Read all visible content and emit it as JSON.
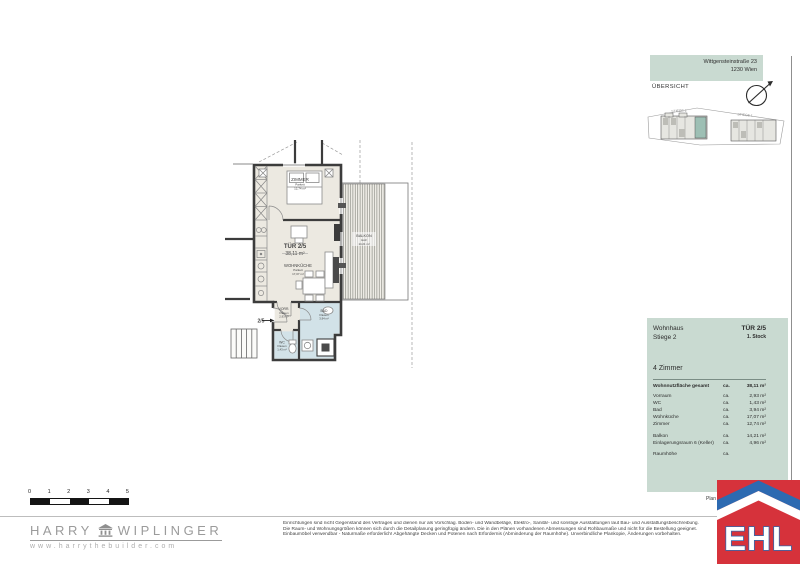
{
  "colors": {
    "panel_teal": "#c9dad1",
    "site_highlight_teal": "#9dbfb4",
    "bath_blue": "#d2e2e8",
    "room_beige": "#ece9e1",
    "ehl_red": "#d6323b",
    "ehl_blue": "#2d6ab1"
  },
  "header": {
    "address_line1": "Wittgensteinstraße 23",
    "address_line2": "1230 Wien",
    "overview_label": "ÜBERSICHT",
    "siteplan": {
      "stiege2_label": "STIEGE 2",
      "stiege1_label": "STIEGE 1"
    }
  },
  "floorplan": {
    "entrance_label": "2/5",
    "unit": {
      "door": "TÜR 2/5",
      "area": "38,11 m²"
    },
    "zimmer": {
      "name": "ZIMMER",
      "floor": "Parkett",
      "area": "12,74 m²"
    },
    "wohnkueche": {
      "name": "WOHNKÜCHE",
      "floor": "Parkett",
      "area": "17,07 m²"
    },
    "vorraum": {
      "name": "VORR.",
      "floor": "Fliesen",
      "area": "2,93 m²"
    },
    "bad": {
      "name": "BAD",
      "floor": "Fliesen",
      "area": "3,94 m²"
    },
    "wc": {
      "name": "WC",
      "floor": "Fliesen",
      "area": "1,43 m²"
    },
    "balkon": {
      "name": "BALKON",
      "floor": "Holz",
      "area": "14,21 m²"
    }
  },
  "info_panel": {
    "building": "Wohnhaus",
    "stair": "Stiege 2",
    "unit": "TÜR 2/5",
    "floor": "1. Stock",
    "rooms": "4 Zimmer",
    "total": {
      "label": "Wohnnutzfläche gesamt",
      "ca": "ca.",
      "value": "38,11 m²"
    },
    "rows": [
      {
        "label": "Vorraum",
        "ca": "ca.",
        "value": "2,93 m²"
      },
      {
        "label": "WC",
        "ca": "ca.",
        "value": "1,43 m²"
      },
      {
        "label": "Bad",
        "ca": "ca.",
        "value": "3,94 m²"
      },
      {
        "label": "Wohnküche",
        "ca": "ca.",
        "value": "17,07 m²"
      },
      {
        "label": "Zimmer",
        "ca": "ca.",
        "value": "12,74 m²"
      }
    ],
    "rows_outdoor": [
      {
        "label": "Balkon",
        "ca": "ca.",
        "value": "14,21 m²"
      },
      {
        "label": "Einlagerungsraum 6 (Keller)",
        "ca": "ca.",
        "value": "4,96 m²"
      }
    ],
    "row_height": {
      "label": "Raumhöhe",
      "ca": "ca.",
      "value": ""
    },
    "plan_note": "Plan"
  },
  "footer": {
    "scalebar": [
      "0",
      "1",
      "2",
      "3",
      "4",
      "5"
    ],
    "harry": {
      "name_left": "HARRY",
      "name_right": "WIPLINGER",
      "url": "www.harrythebuilder.com"
    },
    "disclaimer": {
      "line1": "Einrichtungen sind nicht Gegenstand des Vertrages und dienen nur als Vorschlag. Boden- und Wandbeläge, Elektro-, Sanitär- und sonstige Ausstattungen laut Bau- und Ausstattungsbeschreibung.",
      "line2": "Die Raum- und Wohnungsgrößen können sich durch die Detailplanung geringfügig ändern. Die in den Plänen vorhandenen Abmessungen sind Rohbaumaße und nicht für die Bestellung geeignet.",
      "line3": "Einbaumöbel verwendbar - Naturmaße erforderlich! Abgehängte Decken und Potenen nach Erfordernis (Abminderung der Raumhöhe). Unverbindliche Plankopie, Änderungen vorbehalten."
    },
    "ehl_logo_text": "EHL"
  }
}
